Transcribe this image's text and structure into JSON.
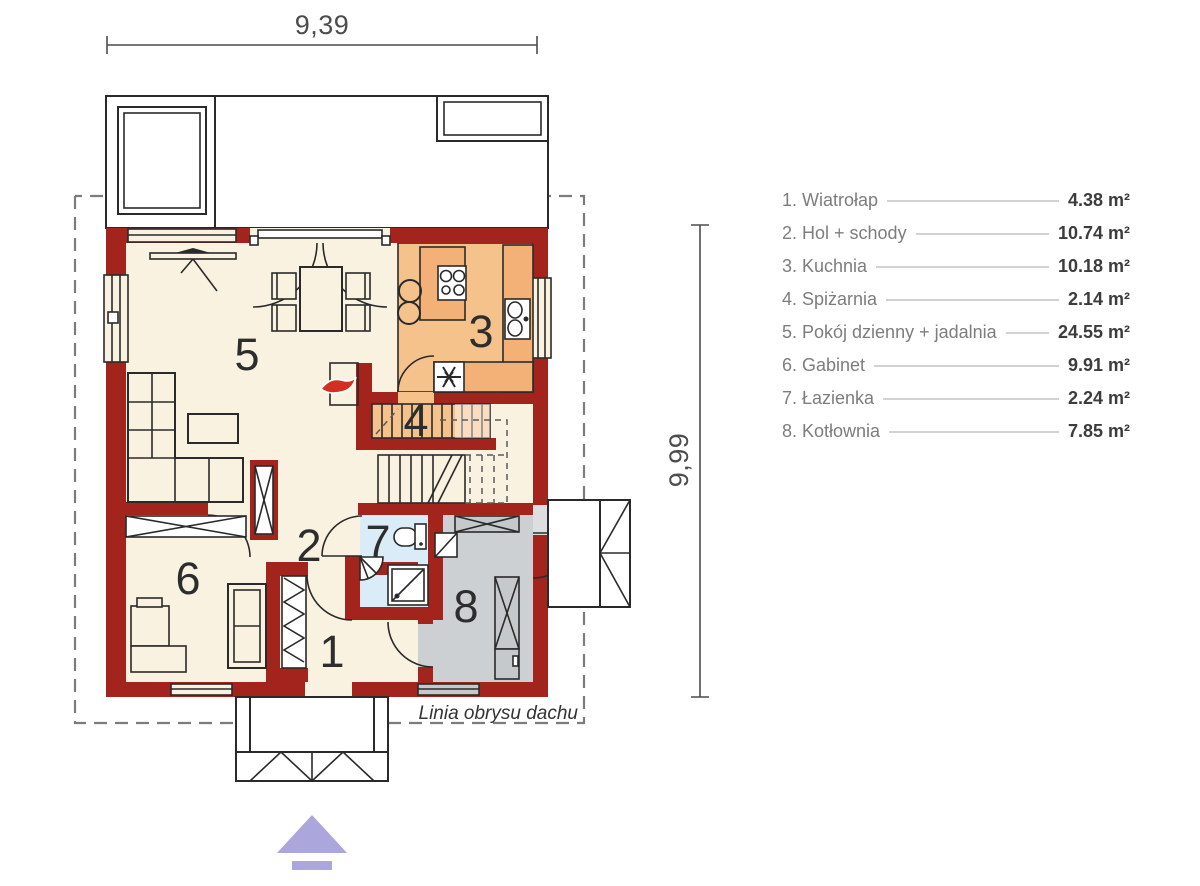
{
  "dimensions": {
    "width_label": "9,39",
    "height_label": "9,99"
  },
  "roof_outline_label": "Linia obrysu dachu",
  "rooms": [
    {
      "number": "1",
      "name": "Wiatrołap",
      "legend_label": "1. Wiatrołap",
      "area": "4.38 m²"
    },
    {
      "number": "2",
      "name": "Hol + schody",
      "legend_label": "2. Hol + schody",
      "area": "10.74 m²"
    },
    {
      "number": "3",
      "name": "Kuchnia",
      "legend_label": "3. Kuchnia",
      "area": "10.18 m²"
    },
    {
      "number": "4",
      "name": "Spiżarnia",
      "legend_label": "4. Spiżarnia",
      "area": "2.14 m²"
    },
    {
      "number": "5",
      "name": "Pokój dzienny + jadalnia",
      "legend_label": "5. Pokój dzienny + jadalnia",
      "area": "24.55 m²"
    },
    {
      "number": "6",
      "name": "Gabinet",
      "legend_label": "6. Gabinet",
      "area": "9.91 m²"
    },
    {
      "number": "7",
      "name": "Łazienka",
      "legend_label": "7. Łazienka",
      "area": "2.24 m²"
    },
    {
      "number": "8",
      "name": "Kotłownia",
      "legend_label": "8. Kotłownia",
      "area": "7.85 m²"
    }
  ],
  "colors": {
    "wall": "#a3231d",
    "floor_cream": "#f9f2e0",
    "kitchen_orange": "#f6c28c",
    "bathroom_blue": "#daecf8",
    "boiler_gray": "#cdd0d2",
    "fireplace_yellow": "#f8ec38",
    "flame_red": "#d42d22",
    "north_arrow_lavender": "#aba6db",
    "legend_label_gray": "#7d7d7d",
    "legend_value_dark": "#3c3c3c"
  }
}
